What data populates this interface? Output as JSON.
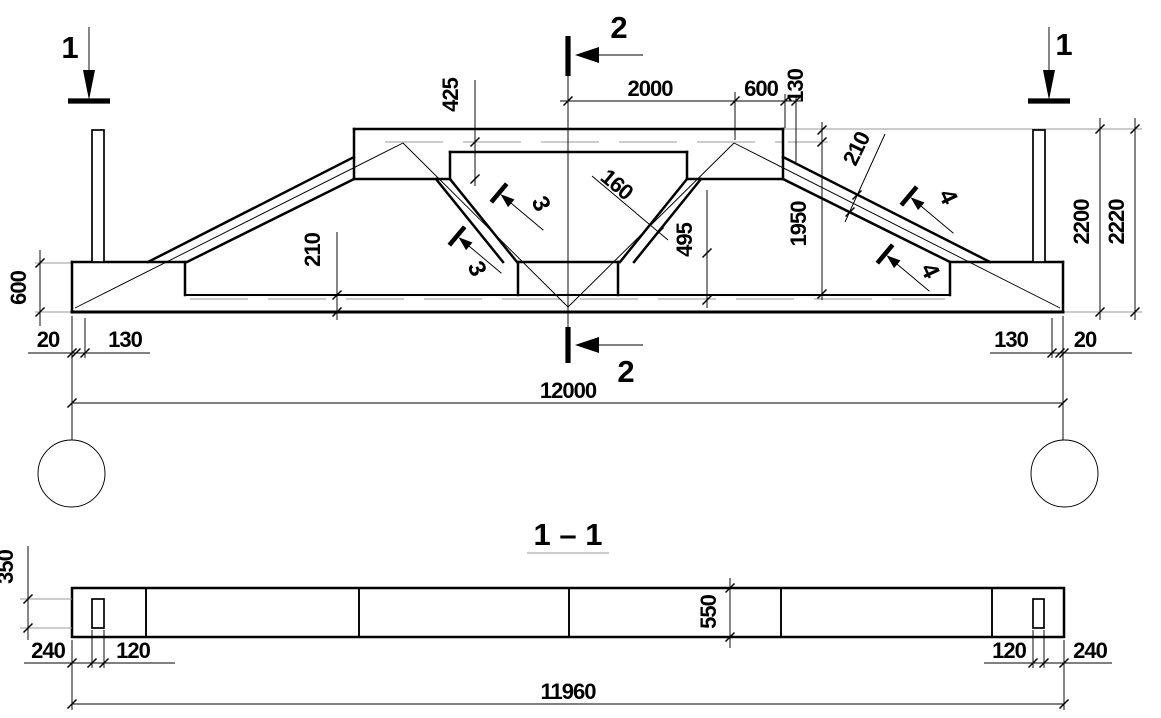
{
  "drawing_type": "reinforced concrete truss working drawing",
  "elevation": {
    "section_mark_1": "1",
    "section_mark_2": "2",
    "flag_3": "3",
    "flag_4": "4",
    "dims": {
      "d425": "425",
      "d2000": "2000",
      "d600_top": "600",
      "d130_top": "130",
      "d160": "160",
      "d495": "495",
      "d1950": "1950",
      "d210_slope": "210",
      "d210_chord": "210",
      "d2200": "2200",
      "d2220": "2220",
      "d600_left": "600",
      "d20_left": "20",
      "d130_left": "130",
      "d130_right": "130",
      "d20_right": "20",
      "d12000": "12000"
    }
  },
  "section_view": {
    "title": "1 – 1",
    "dims": {
      "d350": "350",
      "d550": "550",
      "d240_left": "240",
      "d120_left": "120",
      "d120_right": "120",
      "d240_right": "240",
      "d11960": "11960"
    }
  }
}
